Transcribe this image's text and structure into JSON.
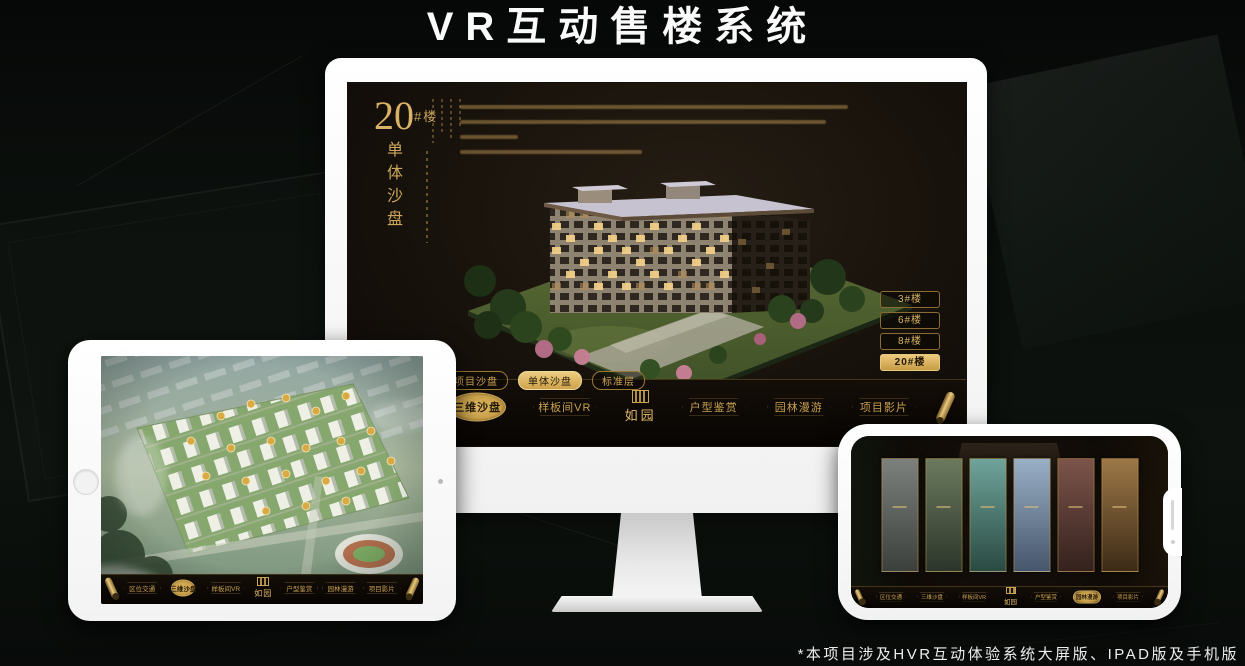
{
  "page": {
    "title": "VR互动售楼系统",
    "footnote": "*本项目涉及HVR互动体验系统大屏版、IPAD版及手机版"
  },
  "colors": {
    "gold": "#c8a050",
    "gold_bright": "#ecca7e",
    "active_tab_bg": "#cfa24a",
    "screen_bg": "#16110c",
    "dark_text": "#241a08"
  },
  "nav": {
    "logo": "如园",
    "items": [
      {
        "label": "区位交通"
      },
      {
        "label": "三维沙盘"
      },
      {
        "label": "样板间VR"
      },
      {
        "label": "户型鉴赏"
      },
      {
        "label": "园林漫游"
      },
      {
        "label": "项目影片"
      }
    ]
  },
  "monitor": {
    "building_title": {
      "number": "20",
      "suffix": "#楼",
      "name": "单体沙盘"
    },
    "floor_buttons": [
      {
        "label": "3#楼",
        "active": false
      },
      {
        "label": "6#楼",
        "active": false
      },
      {
        "label": "8#楼",
        "active": false
      },
      {
        "label": "20#楼",
        "active": true
      }
    ],
    "sub_tabs": [
      {
        "label": "项目沙盘",
        "active": false
      },
      {
        "label": "单体沙盘",
        "active": true
      },
      {
        "label": "标准层",
        "active": false
      }
    ]
  },
  "tablet": {
    "sub_tabs": [
      {
        "label": "项目沙盘",
        "active": true
      },
      {
        "label": "单体沙盘",
        "active": false
      },
      {
        "label": "标准层",
        "active": false
      }
    ]
  }
}
